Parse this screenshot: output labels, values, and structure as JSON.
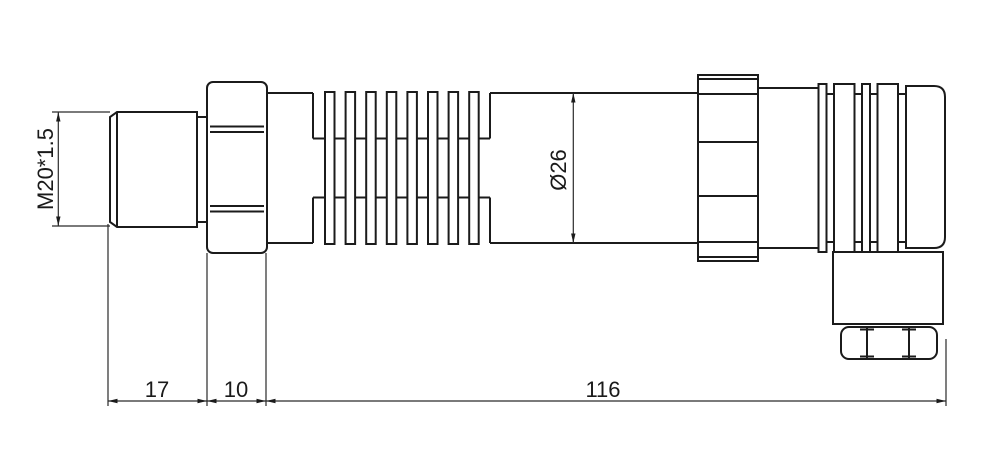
{
  "labels": {
    "thread_spec": "M20*1.5",
    "body_diameter": "Ø26",
    "thread_length": "17",
    "hex_width": "10",
    "body_length": "116"
  },
  "colors": {
    "line": "#1b1b1b",
    "dimension_line": "#2a2a2a",
    "background": "#ffffff"
  }
}
